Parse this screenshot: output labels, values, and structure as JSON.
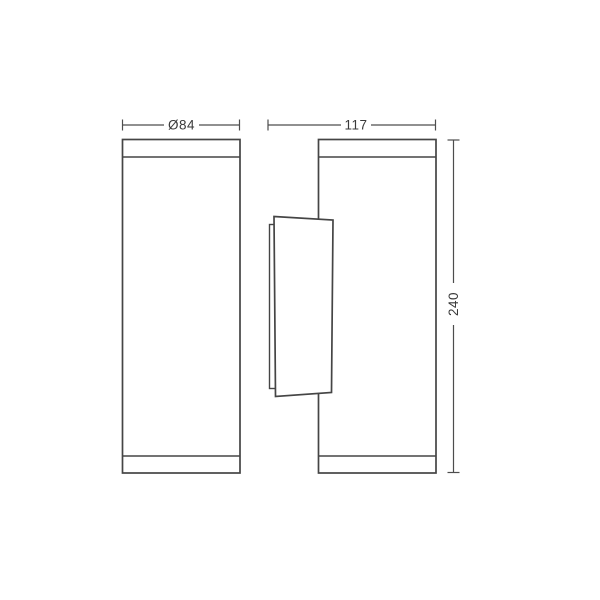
{
  "drawing": {
    "type": "technical-dimension-drawing",
    "subject": "cylindrical wall light, front and side views",
    "colors": {
      "background": "#ffffff",
      "outline": "#454545",
      "dimension_line": "#4d4d4d",
      "label_text": "#3a3a3a"
    },
    "dimensions": {
      "diameter": {
        "label": "Ø84"
      },
      "depth": {
        "label": "117"
      },
      "height": {
        "label": "240"
      }
    }
  }
}
